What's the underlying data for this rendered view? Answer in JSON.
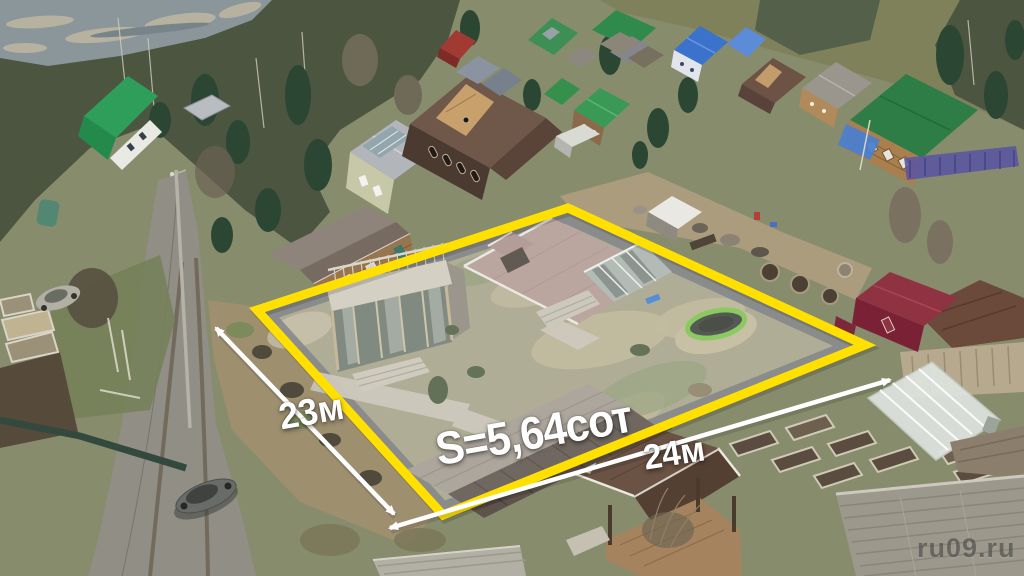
{
  "annotations": {
    "left_dimension": "23м",
    "bottom_dimension": "24м",
    "area_label": "S=5,64сот",
    "watermark": "ru09.ru"
  },
  "colors": {
    "plot_boundary": "#FFE000",
    "dimension_lines": "#FFFFFF",
    "watermark_text": "#3F3F3F"
  }
}
